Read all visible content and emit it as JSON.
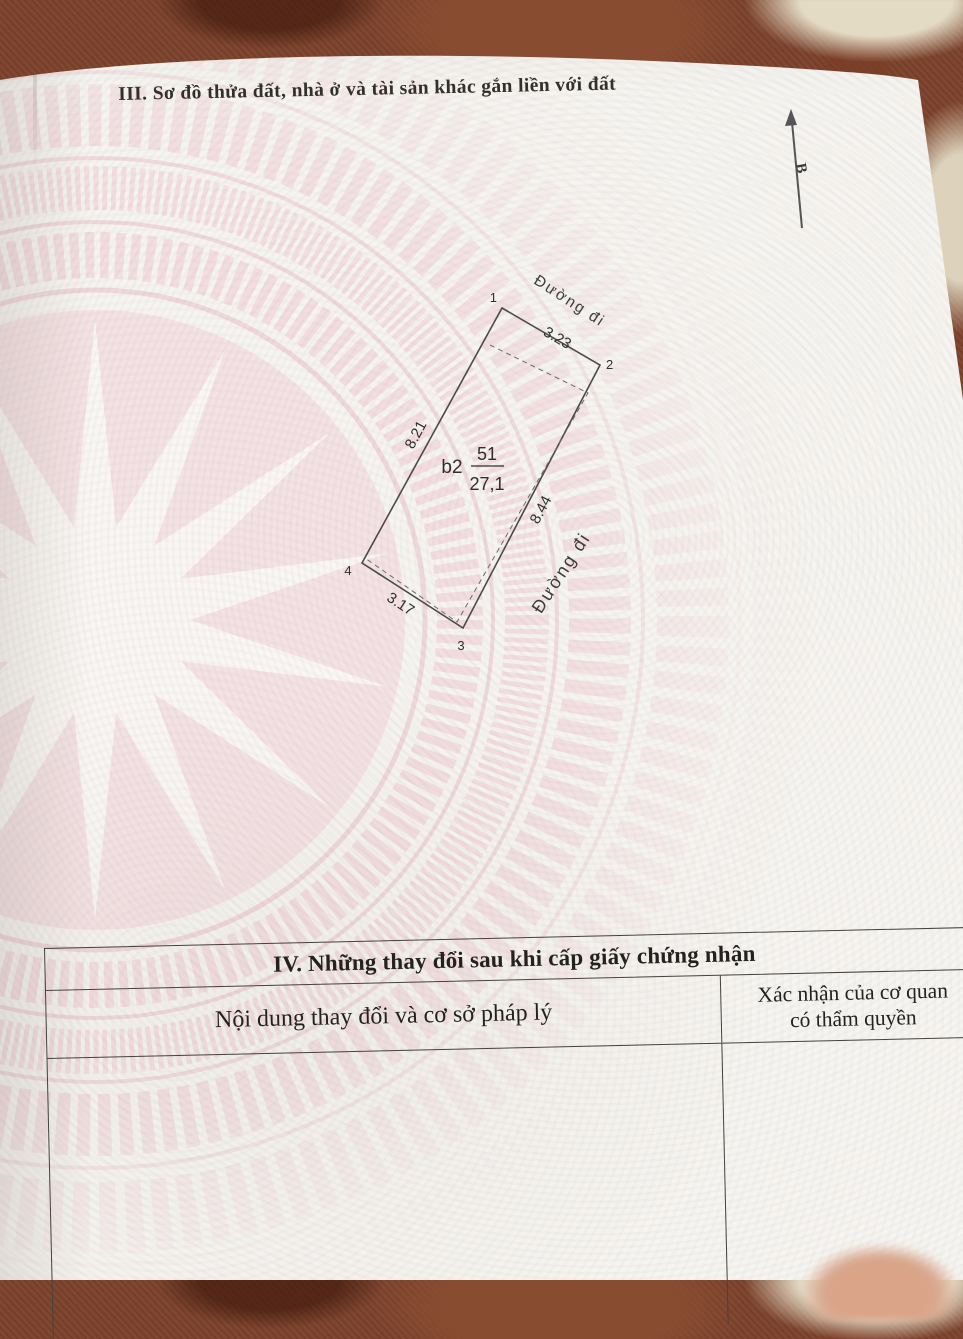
{
  "page": {
    "section_iii_title": "III. Sơ đồ thửa đất, nhà ở và tài sản khác gắn liền với đất",
    "north_arrow_label": "B"
  },
  "diagram": {
    "vertex_labels": {
      "v1": "1",
      "v2": "2",
      "v3": "3",
      "v4": "4"
    },
    "edge_lengths": {
      "top": "3.23",
      "left": "8.21",
      "right": "8.44",
      "bottom": "3.17"
    },
    "parcel_label": {
      "house_code": "b2",
      "parcel_number": "51",
      "area_m2": "27,1"
    },
    "road_label_top": "Đường đi",
    "road_label_right": "Đường đi"
  },
  "section_iv_table": {
    "title": "IV. Những thay đổi sau khi cấp giấy chứng nhận",
    "col1_header": "Nội dung thay đổi và cơ sở pháp lý",
    "col2_header_line1": "Xác nhận của cơ quan",
    "col2_header_line2": "có thẩm quyền"
  },
  "colors": {
    "carpet_brown": "#7c422b",
    "page_white": "#f6f4f0",
    "emblem_pink": "#f0c9d3",
    "diagram_line": "#4a4a4a",
    "text_dark": "#2f2d2a"
  }
}
